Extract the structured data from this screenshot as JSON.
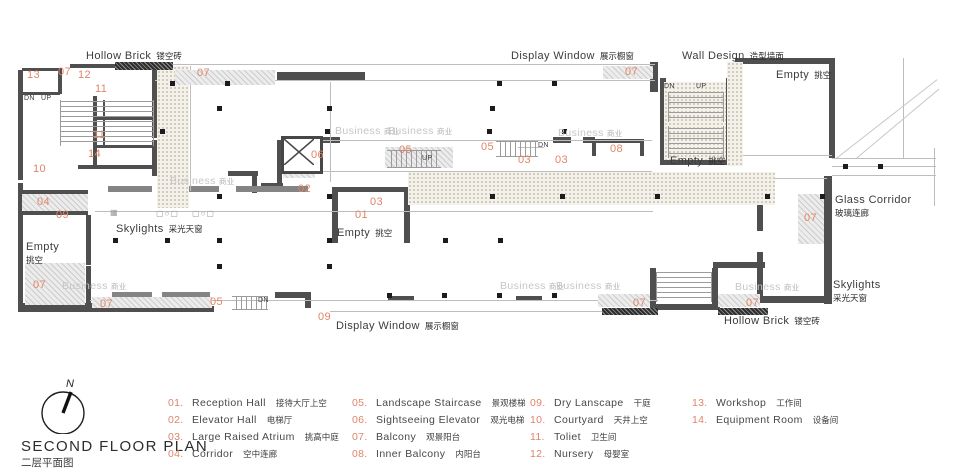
{
  "title_block": {
    "north_label": "N",
    "title": "SECOND FLOOR PLAN",
    "subtitle": "二层平面图"
  },
  "colors": {
    "accent": "#E08568",
    "wall": "#4F4F4F",
    "muted_text": "#C6C6C6"
  },
  "plan": {
    "area_labels": [
      {
        "en": "Hollow Brick",
        "zh": "镂空砖",
        "x": 86,
        "y": 51
      },
      {
        "en": "Display Window",
        "zh": "展示橱窗",
        "x": 511,
        "y": 51
      },
      {
        "en": "Wall Design",
        "zh": "造型墙面",
        "x": 682,
        "y": 51
      },
      {
        "en": "Empty",
        "zh": "挑空",
        "x": 776,
        "y": 70
      },
      {
        "en": "Empty",
        "zh": "挑空",
        "x": 670,
        "y": 156
      },
      {
        "en": "Empty",
        "zh": "挑空",
        "x": 337,
        "y": 228
      },
      {
        "en": "Empty",
        "zh": "挑空",
        "x": 26,
        "y": 242,
        "stacked": true
      },
      {
        "en": "Glass Corridor",
        "zh": "玻璃连廊",
        "x": 835,
        "y": 195,
        "stacked": true
      },
      {
        "en": "Skylights",
        "zh": "采光天窗",
        "x": 833,
        "y": 280,
        "stacked": true
      },
      {
        "en": "Skylights",
        "zh": "采光天窗",
        "x": 116,
        "y": 224
      },
      {
        "en": "Hollow Brick",
        "zh": "镂空砖",
        "x": 724,
        "y": 316
      },
      {
        "en": "Display Window",
        "zh": "展示橱窗",
        "x": 336,
        "y": 321
      }
    ],
    "room_numbers": [
      {
        "n": "13",
        "x": 27,
        "y": 69
      },
      {
        "n": "07",
        "x": 58,
        "y": 66
      },
      {
        "n": "12",
        "x": 78,
        "y": 69
      },
      {
        "n": "11",
        "x": 95,
        "y": 83
      },
      {
        "n": "11",
        "x": 93,
        "y": 129
      },
      {
        "n": "14",
        "x": 88,
        "y": 148
      },
      {
        "n": "10",
        "x": 33,
        "y": 163
      },
      {
        "n": "04",
        "x": 37,
        "y": 196
      },
      {
        "n": "09",
        "x": 56,
        "y": 209
      },
      {
        "n": "07",
        "x": 33,
        "y": 279
      },
      {
        "n": "07",
        "x": 100,
        "y": 298
      },
      {
        "n": "05",
        "x": 210,
        "y": 296
      },
      {
        "n": "09",
        "x": 318,
        "y": 311
      },
      {
        "n": "07",
        "x": 197,
        "y": 67
      },
      {
        "n": "07",
        "x": 625,
        "y": 66
      },
      {
        "n": "06",
        "x": 311,
        "y": 149
      },
      {
        "n": "02",
        "x": 298,
        "y": 183
      },
      {
        "n": "05",
        "x": 399,
        "y": 144
      },
      {
        "n": "03",
        "x": 370,
        "y": 196
      },
      {
        "n": "01",
        "x": 355,
        "y": 209
      },
      {
        "n": "05",
        "x": 481,
        "y": 141
      },
      {
        "n": "03",
        "x": 518,
        "y": 154
      },
      {
        "n": "03",
        "x": 555,
        "y": 154
      },
      {
        "n": "08",
        "x": 610,
        "y": 143
      },
      {
        "n": "07",
        "x": 633,
        "y": 297
      },
      {
        "n": "07",
        "x": 746,
        "y": 297
      },
      {
        "n": "07",
        "x": 804,
        "y": 212
      }
    ],
    "business_label": {
      "en": "Business",
      "zh": "商业"
    },
    "business_positions": [
      [
        170,
        175
      ],
      [
        335,
        125
      ],
      [
        388,
        125
      ],
      [
        558,
        127
      ],
      [
        62,
        280
      ],
      [
        500,
        280
      ],
      [
        556,
        280
      ],
      [
        735,
        281
      ]
    ],
    "stair_labels": [
      {
        "t": "DN",
        "x": 24,
        "y": 95
      },
      {
        "t": "UP",
        "x": 41,
        "y": 95
      },
      {
        "t": "UP",
        "x": 422,
        "y": 155
      },
      {
        "t": "DN",
        "x": 538,
        "y": 142
      },
      {
        "t": "DN",
        "x": 664,
        "y": 83
      },
      {
        "t": "UP",
        "x": 696,
        "y": 83
      },
      {
        "t": "DN",
        "x": 258,
        "y": 297
      }
    ]
  },
  "legend": {
    "columns": [
      {
        "items": [
          {
            "num": "01.",
            "en": "Reception Hall",
            "zh": "接待大厅上空"
          },
          {
            "num": "02.",
            "en": "Elevator Hall",
            "zh": "电梯厅"
          },
          {
            "num": "03.",
            "en": "Large Raised Atrium",
            "zh": "挑高中庭"
          },
          {
            "num": "04.",
            "en": "Corridor",
            "zh": "空中连廊"
          }
        ]
      },
      {
        "items": [
          {
            "num": "05.",
            "en": "Landscape Staircase",
            "zh": "景观楼梯"
          },
          {
            "num": "06.",
            "en": "Sightseeing Elevator",
            "zh": "观光电梯"
          },
          {
            "num": "07.",
            "en": "Balcony",
            "zh": "观景阳台"
          },
          {
            "num": "08.",
            "en": "Inner Balcony",
            "zh": "内阳台"
          }
        ]
      },
      {
        "items": [
          {
            "num": "09.",
            "en": "Dry Lanscape",
            "zh": "干庭"
          },
          {
            "num": "10.",
            "en": "Courtyard",
            "zh": "天井上空"
          },
          {
            "num": "11.",
            "en": "Toliet",
            "zh": "卫生间"
          },
          {
            "num": "12.",
            "en": "Nursery",
            "zh": "母婴室"
          }
        ]
      },
      {
        "items": [
          {
            "num": "13.",
            "en": "Workshop",
            "zh": "工作间"
          },
          {
            "num": "14.",
            "en": "Equipment Room",
            "zh": "设备间"
          }
        ]
      }
    ]
  }
}
